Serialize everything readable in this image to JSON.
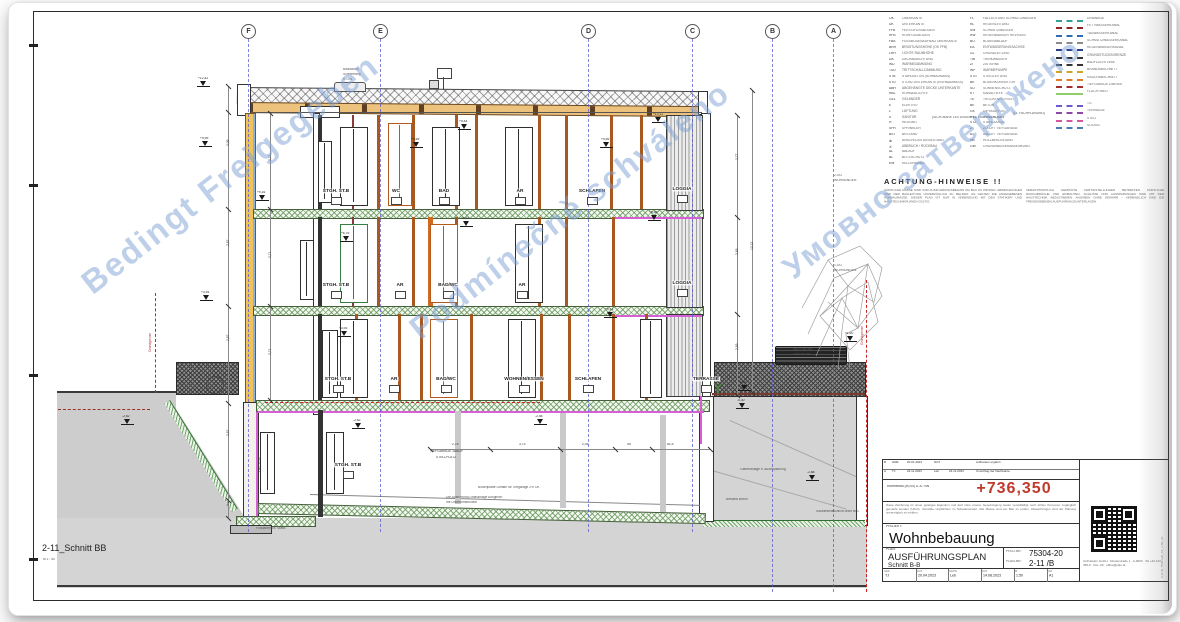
{
  "footer": {
    "title": "2-11_Schnitt BB",
    "scale": "M 1 : 50"
  },
  "colors": {
    "accent_red": "#c0392b",
    "grid_blue": "#5b5bd0",
    "watermark_blue": "#7da0d4",
    "magenta": "#d65fd6"
  },
  "watermarks": [
    {
      "text": "Bedingt Freigegeben",
      "x": 47,
      "y": 155,
      "rot": -38,
      "size": 33
    },
    {
      "text": "Podmínečně schváleno",
      "x": 372,
      "y": 192,
      "rot": -38,
      "size": 32
    },
    {
      "text": "Умовно затверджено",
      "x": 748,
      "y": 140,
      "rot": -38,
      "size": 32
    }
  ],
  "grid": {
    "cols": [
      {
        "label": "F",
        "x": 248,
        "h": 493
      },
      {
        "label": "E",
        "x": 380,
        "h": 493
      },
      {
        "label": "D",
        "x": 588,
        "h": 493
      },
      {
        "label": "C",
        "x": 692,
        "h": 493
      },
      {
        "label": "B",
        "x": 772,
        "h": 553
      },
      {
        "label": "A",
        "x": 833,
        "h": 553
      }
    ]
  },
  "drawing": {
    "rooms": [
      {
        "t": "STGH. ST.B",
        "x": 336,
        "y": 188
      },
      {
        "t": "WC",
        "x": 396,
        "y": 188
      },
      {
        "t": "BAD",
        "x": 444,
        "y": 188
      },
      {
        "t": "AR",
        "x": 520,
        "y": 188
      },
      {
        "t": "SCHLAFEN",
        "x": 592,
        "y": 188
      },
      {
        "t": "LOGGIA",
        "x": 682,
        "y": 186
      },
      {
        "t": "STGH. ST.B",
        "x": 336,
        "y": 282
      },
      {
        "t": "AR",
        "x": 400,
        "y": 282
      },
      {
        "t": "BAD/WC",
        "x": 448,
        "y": 282
      },
      {
        "t": "AR",
        "x": 522,
        "y": 282
      },
      {
        "t": "LOGGIA",
        "x": 682,
        "y": 280
      },
      {
        "t": "STGH. ST.B",
        "x": 338,
        "y": 376
      },
      {
        "t": "AR",
        "x": 394,
        "y": 376
      },
      {
        "t": "BAD/WC",
        "x": 446,
        "y": 376
      },
      {
        "t": "WOHNEN/ESSEN",
        "x": 524,
        "y": 376
      },
      {
        "t": "SCHLAFEN",
        "x": 588,
        "y": 376
      },
      {
        "t": "TERRASSE",
        "x": 706,
        "y": 376
      },
      {
        "t": "STGH. ST.B",
        "x": 348,
        "y": 462
      }
    ],
    "flags": [
      {
        "x": 203,
        "y": 86,
        "v": "+12,42"
      },
      {
        "x": 205,
        "y": 146,
        "v": "+9,99"
      },
      {
        "x": 206,
        "y": 300,
        "v": "+3,93"
      },
      {
        "x": 262,
        "y": 200,
        "v": "+9,16"
      },
      {
        "x": 416,
        "y": 147,
        "v": "+9,59"
      },
      {
        "x": 464,
        "y": 129,
        "v": "+9,44"
      },
      {
        "x": 606,
        "y": 147,
        "v": "+9,59"
      },
      {
        "x": 658,
        "y": 122,
        "v": "+10,11"
      },
      {
        "x": 346,
        "y": 241,
        "v": "+6,76"
      },
      {
        "x": 466,
        "y": 226,
        "v": "+6,61"
      },
      {
        "x": 654,
        "y": 220,
        "v": "+6,58"
      },
      {
        "x": 610,
        "y": 317,
        "v": "+3,73"
      },
      {
        "x": 344,
        "y": 336,
        "v": "+3,93"
      },
      {
        "x": 850,
        "y": 341,
        "v": "+1,20"
      },
      {
        "x": 744,
        "y": 390,
        "v": "-0,15"
      },
      {
        "x": 127,
        "y": 424,
        "v": "-2,62"
      },
      {
        "x": 358,
        "y": 428,
        "v": "-2,62"
      },
      {
        "x": 540,
        "y": 424,
        "v": "-2,55"
      },
      {
        "x": 742,
        "y": 408,
        "v": "-0,30"
      },
      {
        "x": 812,
        "y": 480,
        "v": "-2,88"
      }
    ],
    "posts": [
      [
        318,
        115,
        4,
        94,
        "#333333"
      ],
      [
        352,
        115,
        2,
        94,
        "#8b3a3a"
      ],
      [
        377,
        115,
        3,
        94,
        "#a8591f"
      ],
      [
        412,
        115,
        3,
        94,
        "#a8591f"
      ],
      [
        455,
        115,
        3,
        94,
        "#a8591f"
      ],
      [
        475,
        115,
        3,
        94,
        "#a8591f"
      ],
      [
        538,
        115,
        3,
        94,
        "#a8591f"
      ],
      [
        565,
        115,
        3,
        94,
        "#a8591f"
      ],
      [
        610,
        115,
        3,
        94,
        "#a8591f"
      ],
      [
        640,
        115,
        3,
        94,
        "#a8591f"
      ],
      [
        318,
        217,
        4,
        89,
        "#333333"
      ],
      [
        352,
        217,
        2,
        89,
        "#8b3a3a"
      ],
      [
        377,
        217,
        3,
        89,
        "#a8591f"
      ],
      [
        412,
        217,
        3,
        89,
        "#a8591f"
      ],
      [
        428,
        217,
        5,
        89,
        "#d2691e"
      ],
      [
        455,
        217,
        3,
        89,
        "#a8591f"
      ],
      [
        538,
        217,
        3,
        89,
        "#a8591f"
      ],
      [
        565,
        217,
        3,
        89,
        "#a8591f"
      ],
      [
        612,
        217,
        3,
        89,
        "#a8591f"
      ],
      [
        318,
        314,
        4,
        86,
        "#333333"
      ],
      [
        355,
        314,
        3,
        86,
        "#a8591f"
      ],
      [
        398,
        314,
        3,
        86,
        "#a8591f"
      ],
      [
        420,
        314,
        3,
        86,
        "#a8591f"
      ],
      [
        470,
        314,
        3,
        86,
        "#a8591f"
      ],
      [
        540,
        314,
        3,
        86,
        "#a8591f"
      ],
      [
        568,
        314,
        3,
        86,
        "#a8591f"
      ],
      [
        612,
        314,
        3,
        86,
        "#a8591f"
      ],
      [
        645,
        314,
        3,
        86,
        "#a8591f"
      ],
      [
        318,
        410,
        5,
        107,
        "#333333"
      ],
      [
        455,
        411,
        6,
        93,
        "#c9c9c9"
      ],
      [
        560,
        413,
        6,
        95,
        "#c9c9c9"
      ],
      [
        660,
        415,
        6,
        97,
        "#c9c9c9"
      ]
    ],
    "windows": [
      [
        340,
        127,
        26,
        77,
        "#2f2f2f"
      ],
      [
        388,
        123,
        22,
        81,
        "#b35a1f"
      ],
      [
        432,
        127,
        26,
        77,
        "#2f2f2f"
      ],
      [
        505,
        127,
        26,
        77,
        "#2f2f2f"
      ],
      [
        318,
        141,
        12,
        60,
        "#2f2f2f"
      ],
      [
        340,
        224,
        26,
        77,
        "#3a7d44"
      ],
      [
        430,
        224,
        26,
        77,
        "#b35a1f"
      ],
      [
        515,
        224,
        26,
        77,
        "#2f2f2f"
      ],
      [
        300,
        240,
        12,
        58,
        "#2f2f2f"
      ],
      [
        322,
        330,
        14,
        66,
        "#2f2f2f"
      ],
      [
        340,
        319,
        26,
        77,
        "#2f2f2f"
      ],
      [
        430,
        319,
        26,
        77,
        "#b35a1f"
      ],
      [
        508,
        319,
        26,
        77,
        "#2f2f2f"
      ],
      [
        640,
        319,
        20,
        77,
        "#2f2f2f"
      ],
      [
        326,
        432,
        16,
        60,
        "#2f2f2f"
      ],
      [
        260,
        432,
        13,
        60,
        "#2f2f2f"
      ]
    ],
    "dims": [
      {
        "x": 228,
        "y": 86,
        "len": 432,
        "dir": "v",
        "labels": [
          [
            60,
            "3,05"
          ],
          [
            160,
            "2,87"
          ],
          [
            255,
            "2,87"
          ],
          [
            350,
            "2,87"
          ],
          [
            420,
            "1,10"
          ]
        ],
        "ticks": [
          0,
          26,
          123,
          220,
          317,
          414,
          432
        ]
      },
      {
        "x": 270,
        "y": 113,
        "len": 287,
        "dir": "v",
        "labels": [
          [
            48,
            "2,71"
          ],
          [
            145,
            "2,71"
          ],
          [
            242,
            "2,71"
          ]
        ],
        "ticks": [
          0,
          96,
          193,
          287
        ]
      },
      {
        "x": 737,
        "y": 115,
        "len": 280,
        "dir": "v",
        "labels": [
          [
            45,
            "2,77"
          ],
          [
            140,
            "2,85"
          ],
          [
            235,
            "2,85"
          ]
        ],
        "ticks": [
          0,
          102,
          199,
          280
        ]
      },
      {
        "x": 752,
        "y": 90,
        "len": 302,
        "dir": "v",
        "labels": [
          [
            160,
            "12,12"
          ]
        ],
        "ticks": [
          0,
          302
        ]
      },
      {
        "x": 430,
        "y": 449,
        "len": 280,
        "dir": "h",
        "labels": [
          [
            28,
            "2,76"
          ],
          [
            95,
            "3,75"
          ],
          [
            158,
            "2,05"
          ],
          [
            203,
            "45"
          ],
          [
            243,
            "82,5"
          ]
        ],
        "ticks": [
          0,
          60,
          130,
          185,
          222,
          280
        ]
      }
    ],
    "texts": [
      {
        "t": "Blitzschutz",
        "x": 343,
        "y": 68
      },
      {
        "t": "Schneefang",
        "x": 343,
        "y": 73
      },
      {
        "t": "lt. DIN",
        "x": 343,
        "y": 78
      },
      {
        "t": "2.OG",
        "x": 834,
        "y": 174
      },
      {
        "t": "WOHNUNGEN",
        "x": 834,
        "y": 179
      },
      {
        "t": "1.OG",
        "x": 834,
        "y": 264
      },
      {
        "t": "WOHNUNGEN",
        "x": 834,
        "y": 269
      },
      {
        "t": "Grundgrenze",
        "x": 149,
        "y": 352,
        "rot": -90,
        "c": "#bb3333"
      },
      {
        "t": "Grundgrenze",
        "x": 861,
        "y": 345,
        "rot": -90,
        "c": "#bb3333"
      },
      {
        "t": "LIFT ST.B",
        "x": 259,
        "y": 472,
        "rot": -90,
        "c": "#333333"
      },
      {
        "t": "TIEFGARAGE 1AB/2F",
        "x": 430,
        "y": 450,
        "c": "#333333"
      },
      {
        "t": "STELLPLATZ",
        "x": 436,
        "y": 456,
        "c": "#333333"
      },
      {
        "t": "46,47 üb. NN",
        "x": 793,
        "y": 348
      },
      {
        "t": "OSV Nr. 85",
        "x": 793,
        "y": 353
      },
      {
        "t": "Bodenplatte Gefälle für Tiefgarage 2% OK",
        "x": 478,
        "y": 486
      },
      {
        "t": "Die Ausführung Drainanlage Ausgleich",
        "x": 446,
        "y": 496
      },
      {
        "t": "mit Unterkonstruktion",
        "x": 446,
        "y": 501
      },
      {
        "t": "Gartenanlage lt. Außenplanung",
        "x": 740,
        "y": 468
      },
      {
        "t": "Fundament lt. Statik",
        "x": 256,
        "y": 527
      },
      {
        "t": "Bestand Beton",
        "x": 726,
        "y": 498
      },
      {
        "t": "Sauberkeitsschicht unter BPL",
        "x": 816,
        "y": 510
      },
      {
        "t": "(SICHTBARE LEITUNGEN LT. FACHPLANUNG)",
        "x": 932,
        "y": 116
      },
      {
        "t": "(LT. FACHPLANUNG)",
        "x": 1013,
        "y": 112
      }
    ]
  },
  "legend": {
    "col1": [
      [
        "OK",
        "OBERKANTE"
      ],
      [
        "UK",
        "UNTERKANTE"
      ],
      [
        "FFB",
        "FERTIGFUSSBODEN"
      ],
      [
        "RFB",
        "ROHFUSSBODEN"
      ],
      [
        "FBA",
        "FUSSBODENAUFBAU OBERKANTE"
      ],
      [
        "BRH",
        "BRÜSTUNGSHÖHE (OK FFB)"
      ],
      [
        "LRH",
        "LICHTE RAUMHÖHE"
      ],
      [
        "DA",
        "DACHABDICHTUNG"
      ],
      [
        "WD",
        "WÄRMEDÄMMUNG"
      ],
      [
        "TSD",
        "TRITTSCHALLDÄMMUNG"
      ],
      [
        "STB",
        "STAHLBETON (ROHBAUMASS)"
      ],
      [
        "STU",
        "STURZ UNTERKANTE (ROHBAUMASS)"
      ],
      [
        "ABH",
        "ABGEHÄNGTE DECKE UNTERKANTE"
      ],
      [
        "RBL",
        "ROHBAULICHTE"
      ],
      [
        "GEL",
        "GELÄNDER"
      ],
      [
        "E",
        "ELEKTRO"
      ],
      [
        "L",
        "LÜFTUNG"
      ],
      [
        "S",
        "SANITÄR"
      ],
      [
        "H",
        "HEIZUNG"
      ],
      [
        "SPR",
        "SPRINKLER"
      ],
      [
        "BST",
        "BESTAND"
      ],
      [
        "⊗",
        "ANSCHLUSS AN BESTAND"
      ],
      [
        "✕",
        "ABBRUCH / RÜCKBAU"
      ],
      [
        "AL",
        "ABLAUF"
      ],
      [
        "BL",
        "BLITZSCHUTZ"
      ],
      [
        "KW",
        "KELLERWAND"
      ]
    ],
    "col2": [
      [
        "FL",
        "FALLLEITUNG SCHMUTZWASSER"
      ],
      [
        "RL",
        "REGENLEITUNG"
      ],
      [
        "SW",
        "SCHMUTZWASSER"
      ],
      [
        "RW",
        "REGENWASSER REVISION"
      ],
      [
        "BO",
        "BODENABLAUF"
      ],
      [
        "EA",
        "ENTWÄSSERUNGSACHSE"
      ],
      [
        "GL",
        "GRUNDLEITUNG"
      ],
      [
        "TW",
        "TRINKWASSER"
      ],
      [
        "ZI",
        "ZISTERNE"
      ],
      [
        "WP",
        "WÄRMEPUMPE"
      ],
      [
        "STG",
        "STEIGLEITUNG"
      ],
      [
        "BK",
        "BODENKONVEKTOR"
      ],
      [
        "SO",
        "SONNENSCHUTZ"
      ],
      [
        "KT",
        "KANALTIEFE"
      ],
      [
        "TE",
        "TROCKENESTRICH"
      ],
      [
        "BE",
        "BETON"
      ],
      [
        "GK",
        "GIPSKARTON"
      ],
      [
        "PVC",
        "KUNSTSTOFF"
      ],
      [
        "STZ",
        "STAHLZARGE"
      ],
      [
        "ZT",
        "ZULUFT TIEFGARAGE"
      ],
      [
        "AT",
        "ABLUFT TIEFGARAGE"
      ],
      [
        "HB",
        "HOLZBEKLEIDUNG"
      ],
      [
        "GW",
        "GRUNDWASSERABSENKUNG"
      ]
    ],
    "lines": [
      {
        "y": 20,
        "c": "#33a39a",
        "s": "dashed",
        "l": "DRAINAGE"
      },
      {
        "y": 27,
        "c": "#8e2323",
        "s": "dashed",
        "l": "FETTWASSERKANAL"
      },
      {
        "y": 35,
        "c": "#2f6db3",
        "s": "dashed",
        "l": "TAUWASSERKANAL"
      },
      {
        "y": 42,
        "c": "#8a8a8a",
        "s": "dashed",
        "l": "SCHMUTZWASSERKANAL"
      },
      {
        "y": 49,
        "c": "#2b3f8c",
        "s": "dashed",
        "l": "REGENWASSERKANAL"
      },
      {
        "y": 57,
        "c": "#333333",
        "s": "dashed",
        "l": "GRUNDSTÜCKSGRENZE"
      },
      {
        "y": 64,
        "c": "#333333",
        "s": "dashed",
        "l": "BAUFLUCHTLINIE"
      },
      {
        "y": 71,
        "c": "#d0a428",
        "s": "dashed",
        "l": "BRANDABSCHNITT"
      },
      {
        "y": 79,
        "c": "#e07b2a",
        "s": "dashed",
        "l": "RAUCHABSCHNITT"
      },
      {
        "y": 86,
        "c": "#a03030",
        "s": "dashed",
        "l": "TIEFGARAGE UMRISS"
      },
      {
        "y": 93,
        "c": "#8fd06a",
        "s": "solid",
        "l": "FLUCHTWEG"
      },
      {
        "y": 105,
        "c": "#6a5acd",
        "s": "dashed",
        "l": "TG"
      },
      {
        "y": 112,
        "c": "#8b4aa8",
        "s": "dashed",
        "l": "TERRASSE"
      },
      {
        "y": 120,
        "c": "#d457a0",
        "s": "dashed",
        "l": "STEG"
      },
      {
        "y": 127,
        "c": "#4a7ab5",
        "s": "dashed",
        "l": "SOCKEL"
      }
    ]
  },
  "notes": {
    "heading": "ACHTUNG-HINWEISE !!",
    "p1": "SÄMTLICHE MASSE SIND VOR AUSFÜHRUNGSBEGINN AM BAU ZU PRÜFEN. ABWEICHUNGEN SIND DER BAULEITUNG UNVERZÜGLICH ZU MELDEN. ES GELTEN DIE ANGEGEBENEN ROHBAUMASSE. DIESER PLAN IST NUR IN VERBINDUNG MIT DEN STATIKER- UND HAUSTECHNIKPLÄNEN GÜLTIG.",
    "p2": "VERANTWORTLICH GEPRÜFTE FERTIGSTELLUNGEN BETREFFEN SÄMTLICHE DURCHBRÜCHE UND EINBAUTEN. SCHLITZE UND AUSSPARUNGEN SIND MIT DER HAUSTECHNIK ABZUSTIMMEN. ANGABEN OHNE GEWÄHR – VERBINDLICH SIND DIE FREIGEGEBENEN AUSFÜHRUNGSUNTERLAGEN."
  },
  "titleblock": {
    "rev": [
      [
        "B",
        "GRE",
        "20.01.2023",
        "NOT",
        "",
        "Aufbauten ergänzt."
      ],
      [
        "A",
        "TJ",
        "24.11.2023",
        "Leb",
        "24.11.2023",
        "Umschlag der Dachkante."
      ]
    ],
    "level_label": "Rohfniveau (±0,00) ü. A.: NN",
    "level_value": "+736,350",
    "disclaimer": "Diese Zeichnung ist unser geistiges Eigentum und darf ohne unsere Genehmigung weder vervielfältigt noch dritten Personen zugänglich gemacht werden (UrhG). Verstöße verpflichten zu Schadenersatz. Alle Masse sind am Bau zu prüfen, Abweichungen sind der Planung unverzüglich zu melden.",
    "project_label": "PROJEKT:",
    "project": "Wohnbebauung",
    "plan_label": "PLAN:",
    "plan_title": "AUSFÜHRUNGSPLAN",
    "plan_sub": "Schnitt B-B",
    "projnr_label": "PROJ.NR:",
    "projnr": "75304-20",
    "plannr_label": "PLAN-NR:",
    "plannr": "2-11 /B",
    "cells": [
      {
        "l": "GEZ.",
        "v": "TJ"
      },
      {
        "l": "DAT.",
        "v": "20.04.2023"
      },
      {
        "l": "GEPR.",
        "v": "Leb"
      },
      {
        "l": "DAT.",
        "v": "14.08.2023"
      },
      {
        "l": "M.",
        "v": "1:50"
      },
      {
        "l": "GR.",
        "v": "A1"
      }
    ],
    "address": "Architekten GmbH · Musterstraße 1 · A-0000 · Tel +43 123 456-0 · Fax -99 · office@plan.at",
    "side_text": "2-11-B_75304-20_AF_1-50_A1"
  }
}
